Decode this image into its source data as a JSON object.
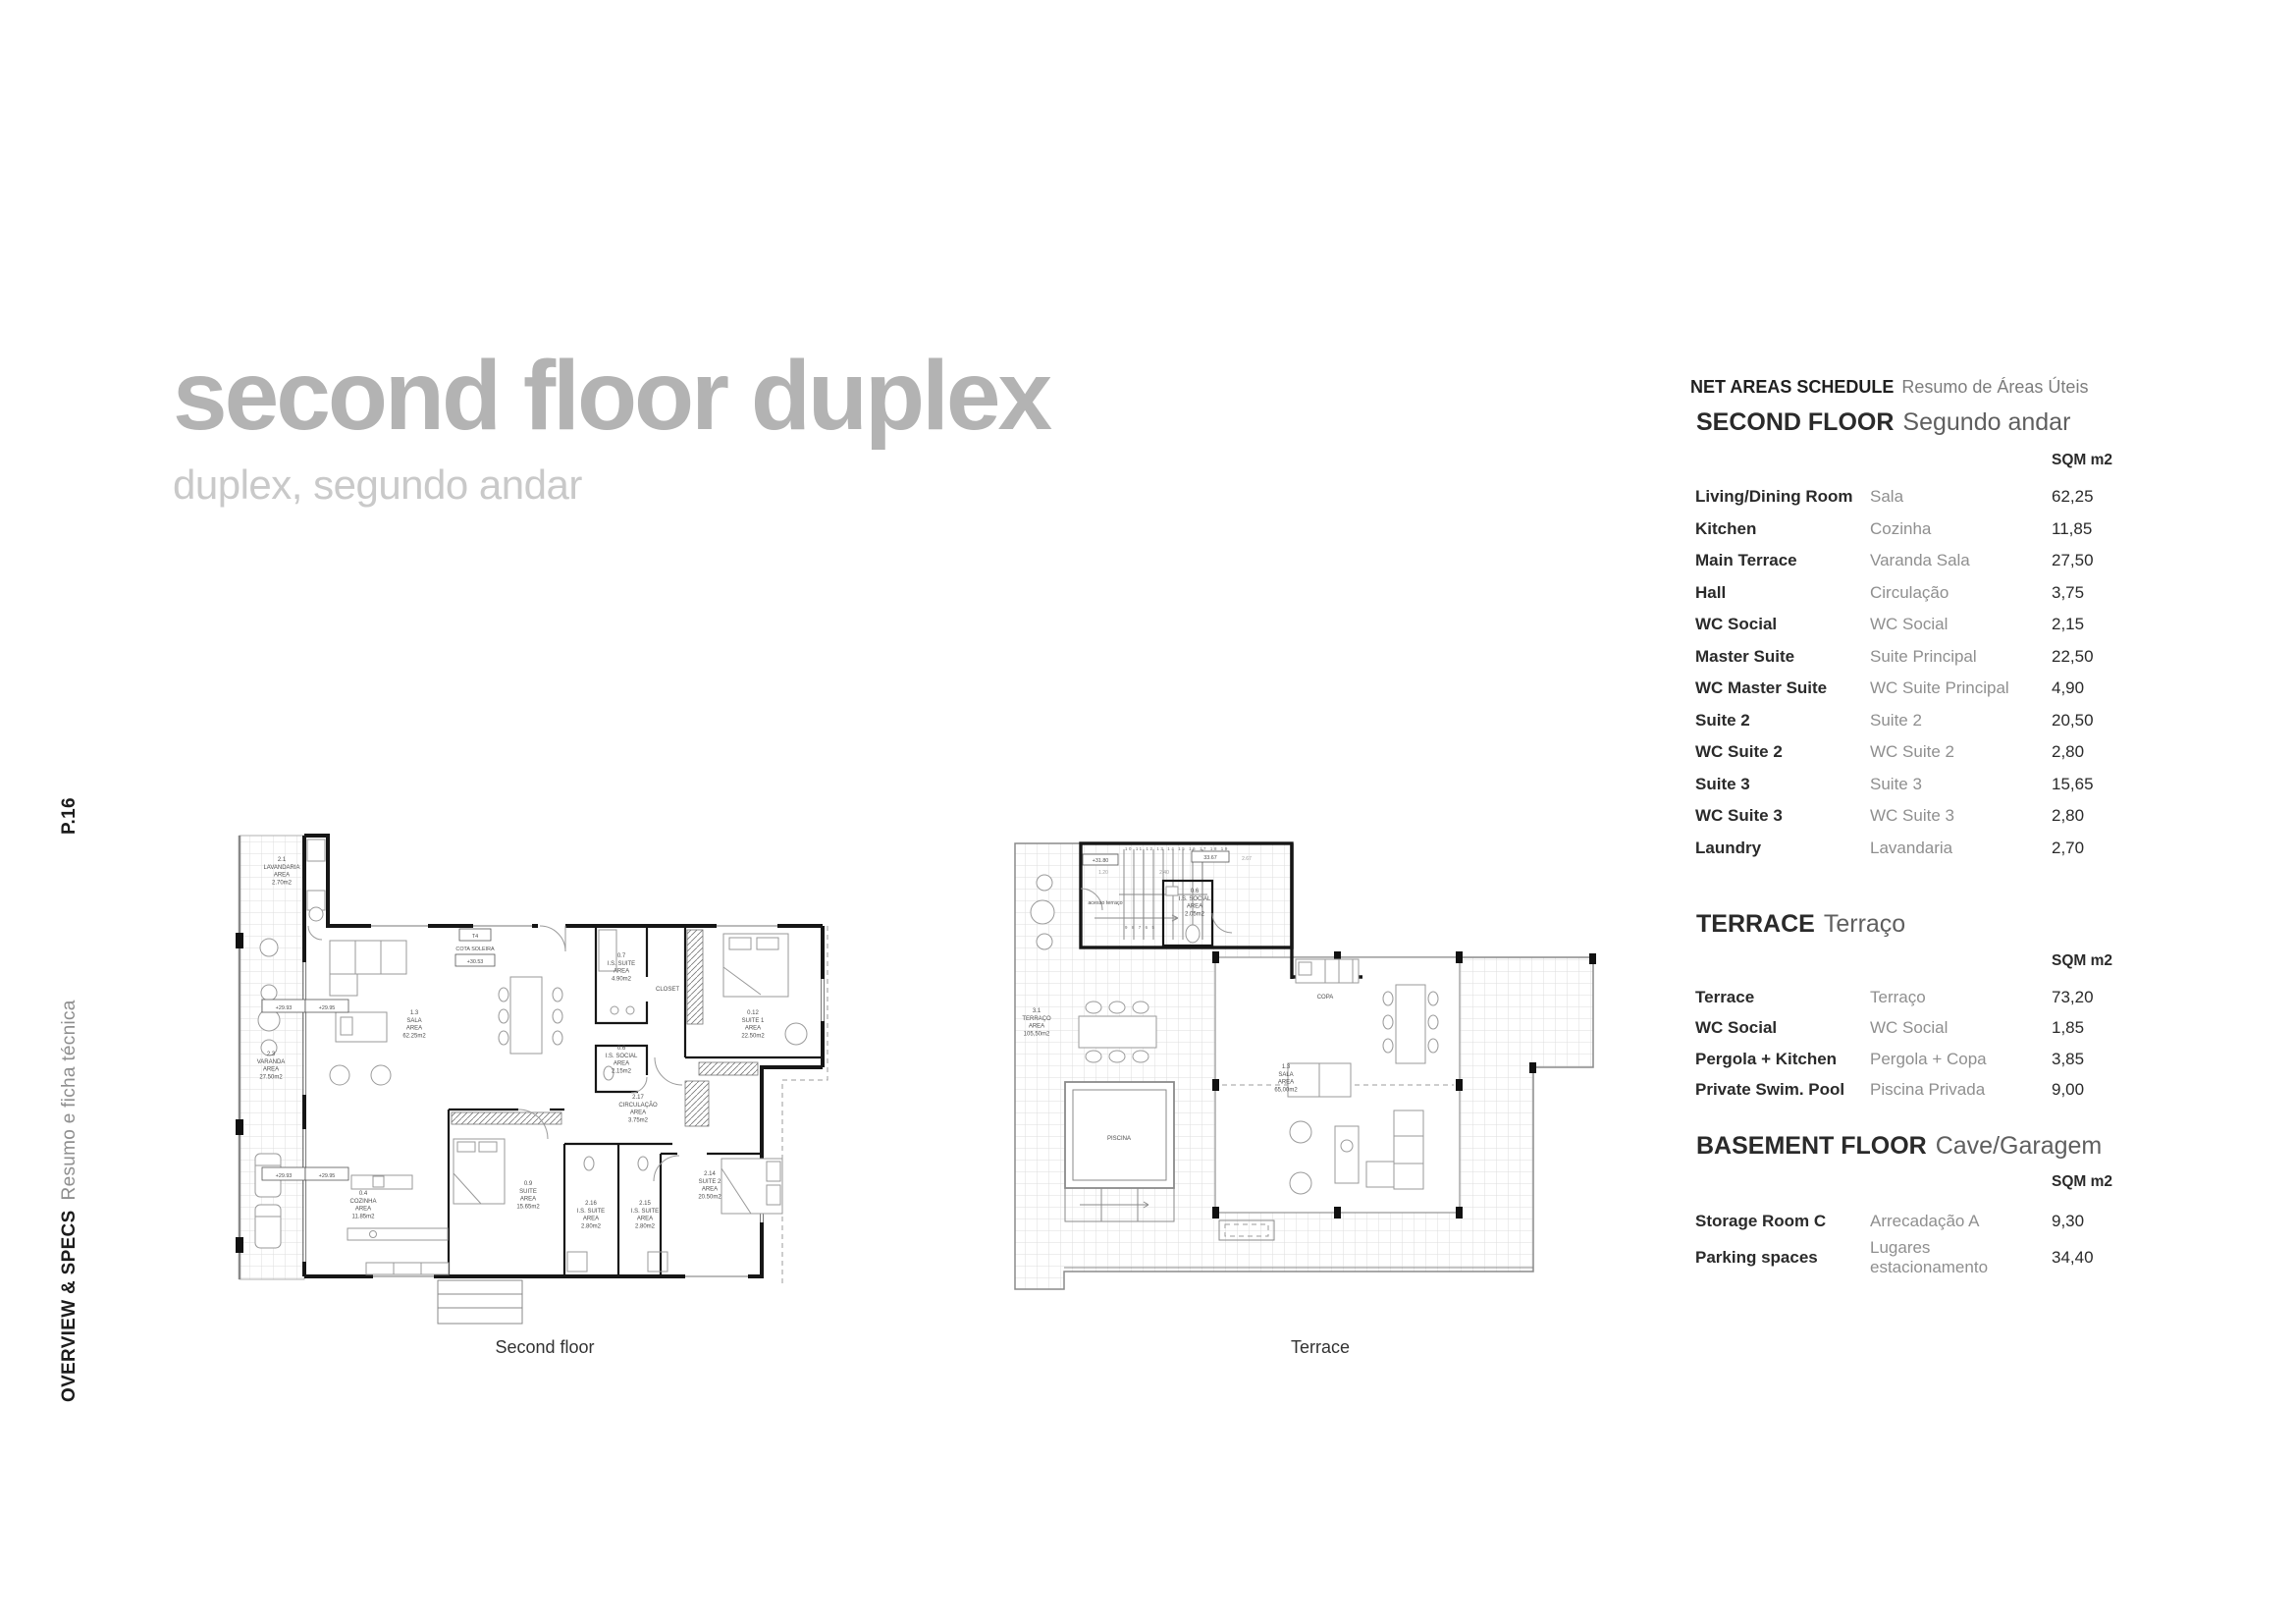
{
  "page": {
    "number": "P.16",
    "section_en": "OVERVIEW & SPECS",
    "section_pt": "Resumo e ficha técnica"
  },
  "title": {
    "main": "second floor duplex",
    "sub": "duplex, segundo andar"
  },
  "schedule": {
    "heading_en": "NET AREAS SCHEDULE",
    "heading_pt": "Resumo de Áreas Úteis",
    "sections": [
      {
        "title_en": "SECOND FLOOR",
        "title_pt": "Segundo andar",
        "unit": "SQM m2",
        "rows": [
          {
            "en": "Living/Dining Room",
            "pt": "Sala",
            "sqm": "62,25"
          },
          {
            "en": "Kitchen",
            "pt": "Cozinha",
            "sqm": "11,85"
          },
          {
            "en": "Main Terrace",
            "pt": "Varanda Sala",
            "sqm": "27,50"
          },
          {
            "en": "Hall",
            "pt": "Circulação",
            "sqm": "3,75"
          },
          {
            "en": "WC Social",
            "pt": "WC Social",
            "sqm": "2,15"
          },
          {
            "en": "Master Suite",
            "pt": "Suite Principal",
            "sqm": "22,50"
          },
          {
            "en": "WC Master Suite",
            "pt": "WC Suite Principal",
            "sqm": "4,90"
          },
          {
            "en": "Suite 2",
            "pt": "Suite 2",
            "sqm": "20,50"
          },
          {
            "en": "WC Suite 2",
            "pt": "WC Suite 2",
            "sqm": "2,80"
          },
          {
            "en": "Suite 3",
            "pt": "Suite 3",
            "sqm": "15,65"
          },
          {
            "en": "WC Suite 3",
            "pt": "WC Suite 3",
            "sqm": "2,80"
          },
          {
            "en": "Laundry",
            "pt": "Lavandaria",
            "sqm": "2,70"
          }
        ]
      },
      {
        "title_en": "TERRACE",
        "title_pt": "Terraço",
        "unit": "SQM m2",
        "rows": [
          {
            "en": "Terrace",
            "pt": "Terraço",
            "sqm": "73,20"
          },
          {
            "en": "WC Social",
            "pt": "WC Social",
            "sqm": "1,85"
          },
          {
            "en": "Pergola + Kitchen",
            "pt": "Pergola + Copa",
            "sqm": "3,85"
          },
          {
            "en": "Private Swim. Pool",
            "pt": "Piscina Privada",
            "sqm": "9,00"
          }
        ]
      },
      {
        "title_en": "BASEMENT FLOOR",
        "title_pt": "Cave/Garagem",
        "unit": "SQM m2",
        "rows": [
          {
            "en": "Storage Room C",
            "pt": "Arrecadação A",
            "sqm": "9,30"
          },
          {
            "en": "Parking spaces",
            "pt": "Lugares estacionamento",
            "sqm": "34,40"
          }
        ]
      }
    ]
  },
  "plans": {
    "second_floor": {
      "caption": "Second floor",
      "labels": [
        [
          "2.1",
          "LAVANDARIA",
          "AREA",
          "2.70m2"
        ],
        [
          "2.3",
          "VARANDA",
          "AREA",
          "27.50m2"
        ],
        [
          "1.3",
          "SALA",
          "AREA",
          "62.25m2"
        ],
        [
          "0.7",
          "I.S. SUITE",
          "AREA",
          "4.90m2"
        ],
        [
          "CLOSET"
        ],
        [
          "0.12",
          "SUITE 1",
          "AREA",
          "22.50m2"
        ],
        [
          "0.6",
          "I.S. SOCIAL",
          "AREA",
          "2.15m2"
        ],
        [
          "2.17",
          "CIRCULAÇÃO",
          "AREA",
          "3.75m2"
        ],
        [
          "0.4",
          "COZINHA",
          "AREA",
          "11.85m2"
        ],
        [
          "0.9",
          "SUITE",
          "AREA",
          "15.65m2"
        ],
        [
          "2.16",
          "I.S. SUITE",
          "AREA",
          "2.80m2"
        ],
        [
          "2.15",
          "I.S. SUITE",
          "AREA",
          "2.80m2"
        ],
        [
          "2.14",
          "SUITE 2",
          "AREA",
          "20.50m2"
        ]
      ],
      "markers": {
        "unit_type": "T4",
        "cota": "COTA SOLEIRA",
        "level": "+30.53",
        "lv_a": "+29.93",
        "lv_b": "+29.95"
      }
    },
    "terrace": {
      "caption": "Terrace",
      "labels": [
        [
          "3.1",
          "TERRAÇO",
          "AREA",
          "105,50m2"
        ],
        [
          "1.3",
          "SALA",
          "AREA",
          "65,00m2"
        ],
        [
          "0.6",
          "I.S. SOCIAL",
          "AREA",
          "2.05m2"
        ],
        [
          "PISCINA"
        ],
        [
          "COPA"
        ],
        [
          "acesso terraço"
        ]
      ],
      "markers": {
        "level": "+31.80",
        "dim_total": "33.67",
        "dim_a": "1.20",
        "dim_b": "2.40",
        "dim_c": "2.67",
        "treads_hi": "10 11 12 13 14 15 16 17 18 19",
        "treads_lo": "9 8 7 6 5"
      }
    }
  }
}
